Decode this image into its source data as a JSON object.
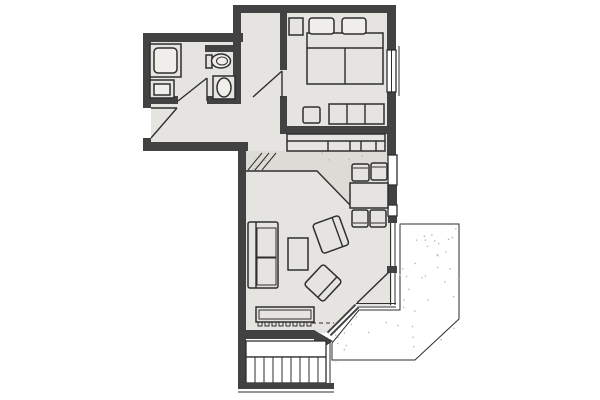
{
  "meta": {
    "kind": "architectural-floor-plan",
    "description": "Black-and-white scanned apartment floor plan: bathroom and bedroom at top, living room with dining nook in the middle, angled terrace at lower right, exterior staircase at bottom"
  },
  "colors": {
    "background": "#ffffff",
    "floor": "#e5e4e1",
    "floor_light": "#efeeea",
    "terrace": "#e2e1de",
    "band": "#dcdbd6",
    "wall": "#424242",
    "line": "#2e2e2e",
    "white": "#ffffff",
    "speckle": "#b9b8b4"
  },
  "rooms": {
    "bathroom": {
      "name": "bathroom",
      "fixtures": [
        "shower",
        "washing-machine",
        "toilet",
        "washbasin"
      ],
      "doors": [
        "bathroom-door"
      ]
    },
    "vestibule": {
      "name": "vestibule",
      "doors": [
        "bedroom-door"
      ]
    },
    "hallway": {
      "name": "hallway",
      "doors": [
        "entry-door"
      ]
    },
    "bedroom": {
      "name": "bedroom",
      "furniture": [
        "nightstand",
        "double-bed",
        "pillow-left",
        "pillow-right",
        "stool",
        "dresser"
      ],
      "windows": [
        "east-window"
      ]
    },
    "living_room": {
      "name": "living-room",
      "furniture": [
        "sideboard",
        "dining-table",
        "dining-chairs-4",
        "armchair-upper",
        "armchair-lower",
        "sofa",
        "coffee-table",
        "bench",
        "radiator"
      ],
      "features": [
        "sloped-ceiling-band",
        "terrace-door"
      ]
    },
    "terrace": {
      "name": "terrace",
      "shape": "beveled-corner-polygon"
    },
    "stairs": {
      "name": "exterior-stairs",
      "parts": [
        "landing",
        "treads"
      ]
    }
  },
  "decor": {
    "stair_tread_count": 8,
    "radiator_tick_count": 8,
    "terrace_speckle_count": 70,
    "band_speckle_count": 26,
    "hatch_line_count": 3
  }
}
